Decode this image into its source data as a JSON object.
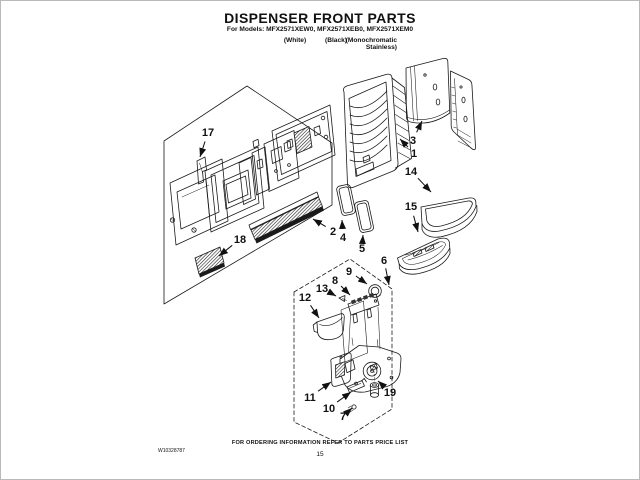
{
  "header": {
    "title": "DISPENSER FRONT PARTS",
    "models_line": "For Models: MFX2571XEW0, MFX2571XEB0, MFX2571XEM0",
    "finish_labels": {
      "white": "(White)",
      "black": "(Black)",
      "mono_line1": "(Monochromatic",
      "mono_line2": "Stainless)"
    }
  },
  "diagram": {
    "line_color": "#1a1a1a",
    "callouts": [
      {
        "n": "17",
        "lx": 207,
        "ly": 131,
        "tx": 199,
        "ty": 156
      },
      {
        "n": "18",
        "lx": 239,
        "ly": 238,
        "tx": 218,
        "ty": 255
      },
      {
        "n": "2",
        "lx": 332,
        "ly": 230,
        "tx": 312,
        "ty": 218
      },
      {
        "n": "4",
        "lx": 342,
        "ly": 236,
        "tx": 341,
        "ty": 219
      },
      {
        "n": "5",
        "lx": 361,
        "ly": 247,
        "tx": 362,
        "ty": 234
      },
      {
        "n": "3",
        "lx": 412,
        "ly": 139,
        "tx": 421,
        "ty": 120
      },
      {
        "n": "1",
        "lx": 413,
        "ly": 152,
        "tx": 399,
        "ty": 138
      },
      {
        "n": "14",
        "lx": 410,
        "ly": 170,
        "tx": 430,
        "ty": 191
      },
      {
        "n": "15",
        "lx": 410,
        "ly": 205,
        "tx": 417,
        "ty": 231
      },
      {
        "n": "6",
        "lx": 383,
        "ly": 259,
        "tx": 388,
        "ty": 284
      },
      {
        "n": "9",
        "lx": 348,
        "ly": 270,
        "tx": 366,
        "ty": 283
      },
      {
        "n": "8",
        "lx": 334,
        "ly": 279,
        "tx": 349,
        "ty": 294
      },
      {
        "n": "13",
        "lx": 321,
        "ly": 287,
        "tx": 335,
        "ty": 295
      },
      {
        "n": "12",
        "lx": 304,
        "ly": 296,
        "tx": 318,
        "ty": 317
      },
      {
        "n": "11",
        "lx": 309,
        "ly": 396,
        "tx": 330,
        "ty": 381
      },
      {
        "n": "10",
        "lx": 328,
        "ly": 407,
        "tx": 350,
        "ty": 391
      },
      {
        "n": "7",
        "lx": 342,
        "ly": 415,
        "tx": 351,
        "ty": 407
      },
      {
        "n": "19",
        "lx": 389,
        "ly": 391,
        "tx": 377,
        "ty": 380
      }
    ]
  },
  "footer": {
    "note": "FOR ORDERING INFORMATION REFER TO PARTS PRICE LIST",
    "page_number": "15",
    "doc_number": "W10328787"
  }
}
